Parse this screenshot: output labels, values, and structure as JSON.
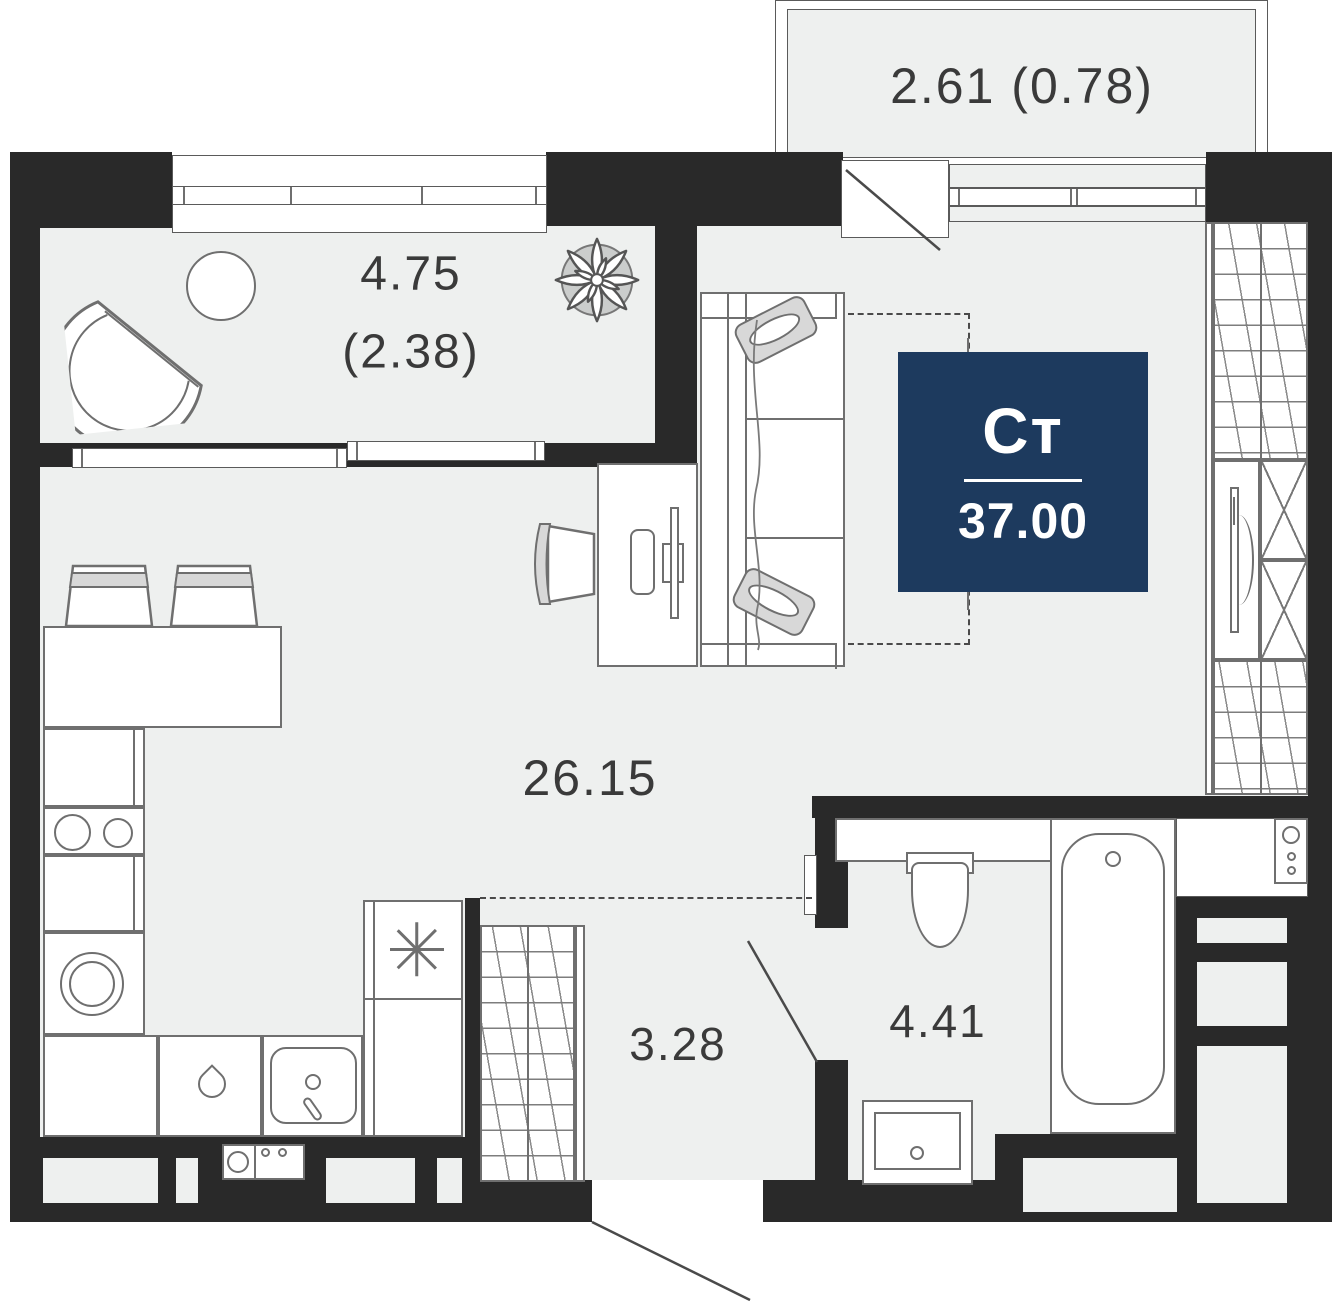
{
  "plan": {
    "badge": {
      "type_label": "Ст",
      "area_value": "37.00"
    },
    "rooms": {
      "balcony": {
        "label": "2.61 (0.78)"
      },
      "loggia": {
        "area": "4.75",
        "area_reduced": "(2.38)"
      },
      "living": {
        "area": "26.15"
      },
      "hallway": {
        "area": "3.28"
      },
      "bathroom": {
        "area": "4.41"
      }
    },
    "colors": {
      "wall": "#292929",
      "floor": "#eef0ef",
      "accent": "#1d3a5e",
      "line": "#6f6f6f",
      "light_fill": "#d8d8d8"
    },
    "icons": [
      "snowflake-icon",
      "plant-icon",
      "teardrop-icon",
      "bathtub",
      "toilet",
      "sink",
      "sofa",
      "desk",
      "chair",
      "armchair",
      "round-table",
      "bar-stool",
      "wardrobe",
      "tv",
      "washing-machine",
      "cooktop"
    ]
  }
}
